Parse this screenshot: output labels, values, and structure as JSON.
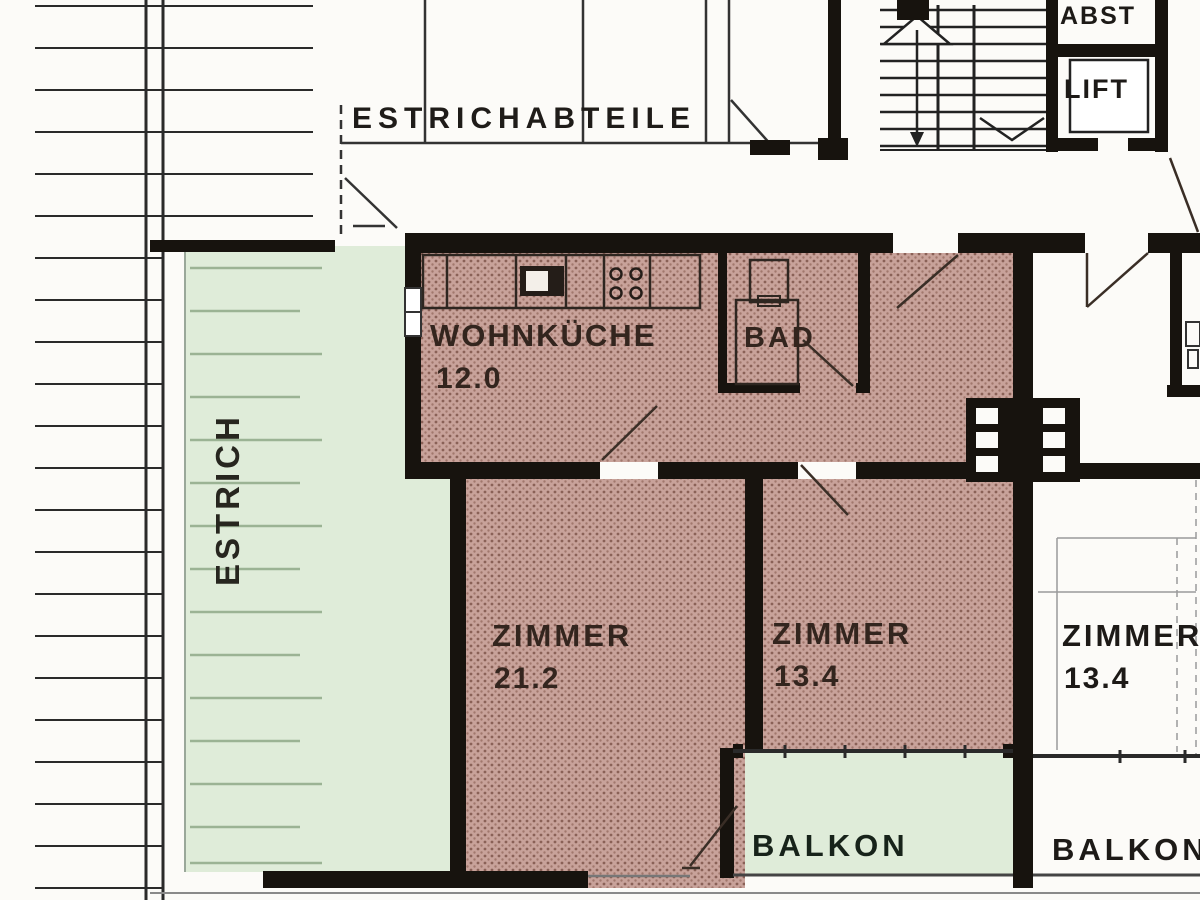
{
  "floor_plan": {
    "common": {
      "attic_compartments_label": "ESTRICHABTEILE",
      "storage_label": "ABST",
      "elevator_label": "LIFT",
      "attic_label": "ESTRICH"
    },
    "apartment": {
      "kitchen_name": "WOHNKÜCHE",
      "kitchen_area": "12.0",
      "bath_name": "BAD",
      "room1_name": "ZIMMER",
      "room1_area": "21.2",
      "room2_name": "ZIMMER",
      "room2_area": "13.4",
      "balcony_name": "BALKON"
    },
    "neighbor": {
      "room_name": "ZIMMER",
      "room_area": "13.4",
      "balcony_name": "BALKON"
    },
    "colors": {
      "wall": "#17130e",
      "apartment_fill": "#c8a29a",
      "apartment_hatch": "#8a6157",
      "common_area_fill": "#dfecd9",
      "attic_hatch_line": "#9bb394",
      "label_text": "#241d18"
    }
  }
}
